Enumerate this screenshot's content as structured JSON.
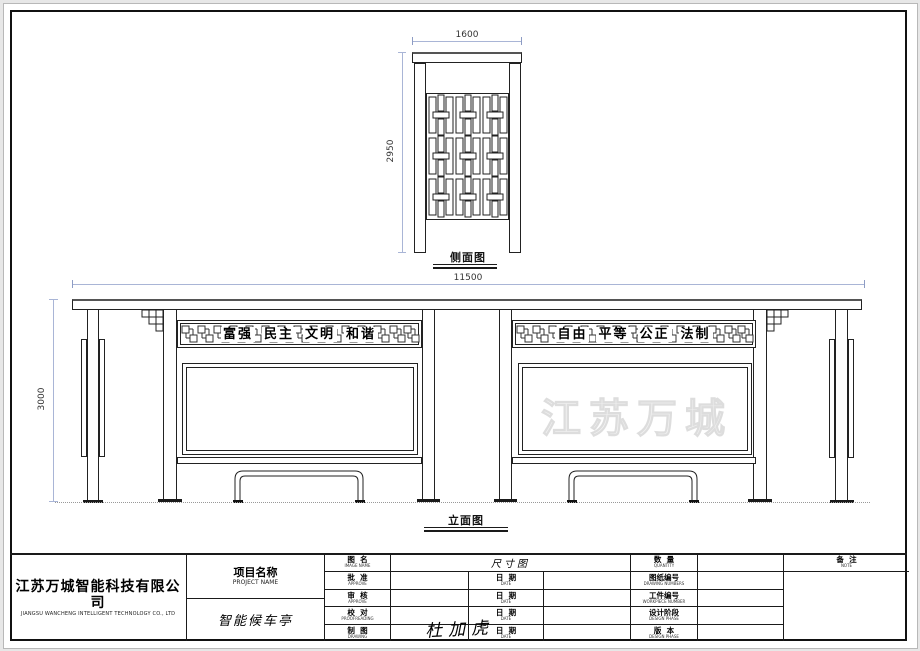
{
  "sheet": {
    "bg": "#e7e7e7",
    "drawing_bg": "#ffffff",
    "line_color": "#1a1a1a",
    "dim_color": "#a9b5d6",
    "watermark_color": "#f1f1f1"
  },
  "side_view": {
    "label": "侧面图",
    "width_dim": "1600",
    "height_dim": "2950"
  },
  "elevation": {
    "label": "立面图",
    "width_dim": "11500",
    "height_dim": "3000",
    "left_band": [
      "富强",
      "民主",
      "文明",
      "和谐"
    ],
    "right_band": [
      "自由",
      "平等",
      "公正",
      "法制"
    ],
    "watermark": "江苏万城"
  },
  "title_block": {
    "company_cn": "江苏万城智能科技有限公司",
    "company_en": "JIANGSU WANCHENG INTELLIGENT TECHNOLOGY CO., LTD",
    "project_label_cn": "项目名称",
    "project_label_en": "PROJECT NAME",
    "project_name": "智能候车亭",
    "drawing_type": "尺寸图",
    "signature": "杜加虎",
    "left_rows": [
      {
        "cn": "图  名",
        "en": "IMAGE NAME"
      },
      {
        "cn": "批  准",
        "en": "APPROVE"
      },
      {
        "cn": "审  核",
        "en": "APPROVE"
      },
      {
        "cn": "校  对",
        "en": "PROOFREADING"
      },
      {
        "cn": "制  图",
        "en": "DRAWING"
      }
    ],
    "date_cn": "日  期",
    "date_en": "DATE",
    "right_rows": [
      {
        "cn": "数  量",
        "en": "QUANTITY"
      },
      {
        "cn": "图纸编号",
        "en": "DRAWING NUMBERS"
      },
      {
        "cn": "工件编号",
        "en": "WORKPIECE NUMBER"
      },
      {
        "cn": "设计阶段",
        "en": "DESIGN PHASE"
      },
      {
        "cn": "版  本",
        "en": "DESIGN PHASE"
      }
    ],
    "note_cn": "备  注",
    "note_en": "NOTE"
  }
}
